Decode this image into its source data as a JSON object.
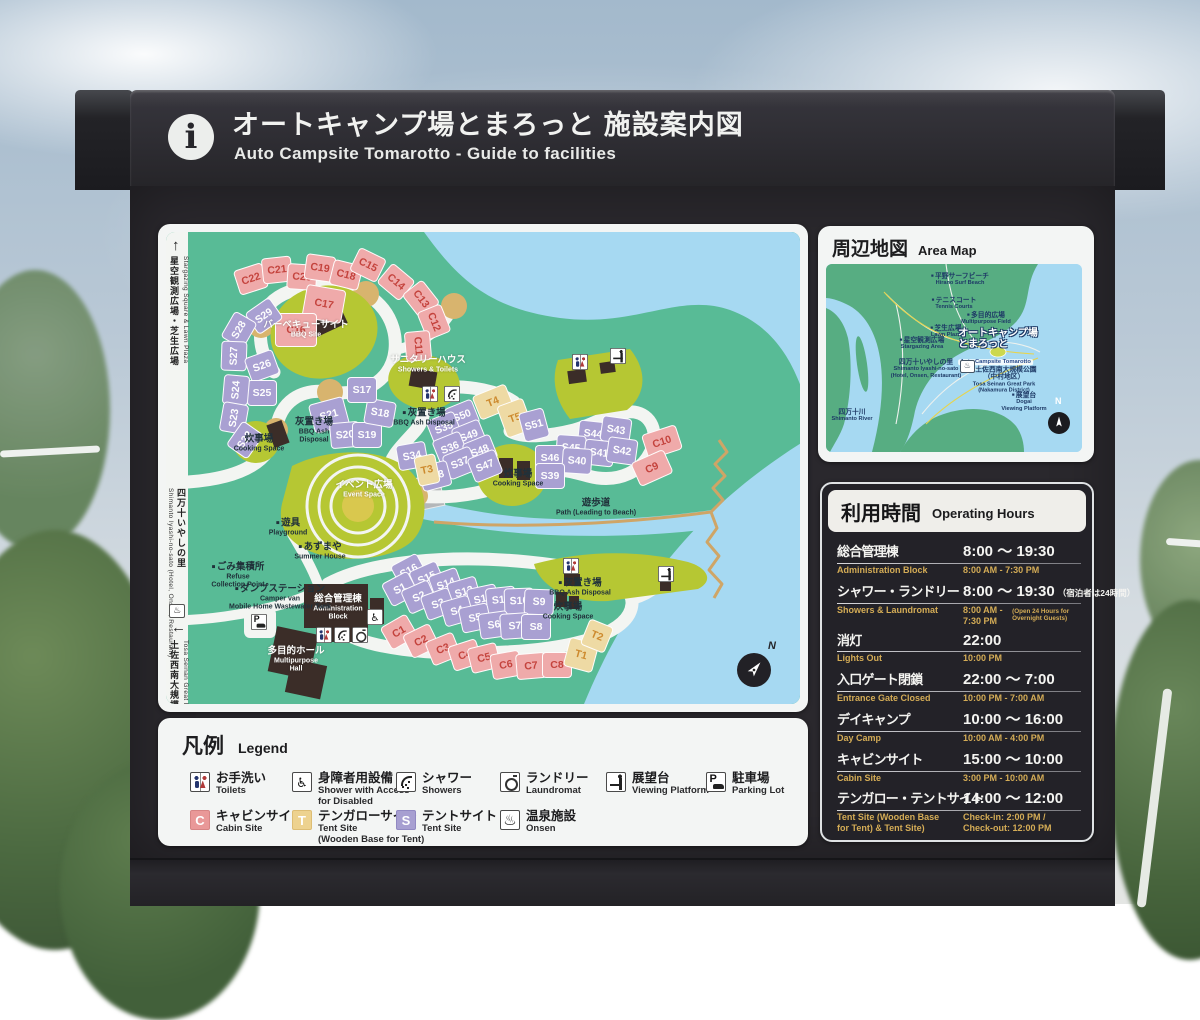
{
  "header": {
    "title_jp": "オートキャンプ場とまろっと 施設案内図",
    "title_en": "Auto Campsite Tomarotto - Guide to facilities",
    "info_icon": "i"
  },
  "main_map": {
    "compass_label": "N",
    "edge_routes": {
      "top": {
        "arrow": "↑",
        "jp": "星空観測広場・芝生広場",
        "en": "Stargazing Square & Lawn Plaza"
      },
      "middle": {
        "arrow": "←",
        "jp": "四万十いやしの里",
        "en": "Shimanto Iyashi-no-sato (Hotel, Onsen, Restaurant)",
        "onsen_icon": "♨"
      },
      "bottom": {
        "arrow": "↓",
        "jp": "土佐西南大規模公園",
        "en": "Tosa Seinan Great Park"
      }
    },
    "sites": [
      [
        "C22",
        "c",
        85,
        47,
        -18
      ],
      [
        "C21",
        "c",
        111,
        38,
        -6
      ],
      [
        "C20",
        "c",
        136,
        45,
        4
      ],
      [
        "C19",
        "c",
        154,
        36,
        8
      ],
      [
        "C18",
        "c",
        180,
        43,
        14
      ],
      [
        "C15",
        "c",
        202,
        33,
        26
      ],
      [
        "C14",
        "c",
        230,
        50,
        40
      ],
      [
        "C13",
        "c",
        255,
        67,
        52
      ],
      [
        "C12",
        "c",
        268,
        90,
        68
      ],
      [
        "C11",
        "c",
        252,
        114,
        85
      ],
      [
        "C17",
        "c",
        158,
        72,
        10,
        40,
        34
      ],
      [
        "C16",
        "c",
        130,
        98,
        0,
        42,
        34
      ],
      [
        "S29",
        "s",
        98,
        84,
        -35
      ],
      [
        "S28",
        "s",
        73,
        98,
        -60
      ],
      [
        "S27",
        "s",
        68,
        124,
        -88
      ],
      [
        "S26",
        "s",
        96,
        134,
        -20
      ],
      [
        "S25",
        "s",
        96,
        161,
        0
      ],
      [
        "S24",
        "s",
        70,
        158,
        -85
      ],
      [
        "S23",
        "s",
        68,
        186,
        -80
      ],
      [
        "S22",
        "s",
        79,
        208,
        -55
      ],
      [
        "S21",
        "s",
        163,
        183,
        -15,
        36,
        30
      ],
      [
        "S20",
        "s",
        179,
        203,
        -5
      ],
      [
        "S19",
        "s",
        201,
        203,
        0
      ],
      [
        "S18",
        "s",
        214,
        181,
        10
      ],
      [
        "S17",
        "s",
        196,
        158,
        0
      ],
      [
        "T4",
        "t",
        327,
        170,
        -22,
        36,
        26
      ],
      [
        "T5",
        "t",
        349,
        186,
        -20,
        28,
        34
      ],
      [
        "S50",
        "s",
        296,
        184,
        -22
      ],
      [
        "S35",
        "s",
        278,
        196,
        -22
      ],
      [
        "S49",
        "s",
        303,
        204,
        -22
      ],
      [
        "S36",
        "s",
        284,
        216,
        -22
      ],
      [
        "S48",
        "s",
        314,
        219,
        -22
      ],
      [
        "S34",
        "s",
        246,
        224,
        -10
      ],
      [
        "S37",
        "s",
        294,
        231,
        -22
      ],
      [
        "S47",
        "s",
        319,
        234,
        -22
      ],
      [
        "S38",
        "s",
        269,
        244,
        -15
      ],
      [
        "T3",
        "t",
        261,
        238,
        -12,
        22,
        30
      ],
      [
        "S51",
        "s",
        368,
        193,
        -15,
        26,
        30
      ],
      [
        "S44",
        "s",
        427,
        202,
        6
      ],
      [
        "S43",
        "s",
        450,
        198,
        8
      ],
      [
        "S45",
        "s",
        405,
        216,
        4
      ],
      [
        "S41",
        "s",
        433,
        221,
        6
      ],
      [
        "S42",
        "s",
        456,
        219,
        8
      ],
      [
        "S46",
        "s",
        384,
        226,
        0
      ],
      [
        "S40",
        "s",
        411,
        229,
        4
      ],
      [
        "S39",
        "s",
        384,
        244,
        0
      ],
      [
        "C10",
        "c",
        496,
        210,
        -18,
        36,
        26
      ],
      [
        "C9",
        "c",
        486,
        236,
        -24,
        36,
        26
      ],
      [
        "S16",
        "s",
        243,
        339,
        -28
      ],
      [
        "S15",
        "s",
        261,
        346,
        -24
      ],
      [
        "S14",
        "s",
        280,
        352,
        -20
      ],
      [
        "S13",
        "s",
        298,
        360,
        -16
      ],
      [
        "S12",
        "s",
        317,
        367,
        -12
      ],
      [
        "S11",
        "s",
        335,
        368,
        -6
      ],
      [
        "S10",
        "s",
        353,
        369,
        -2
      ],
      [
        "S9",
        "s",
        373,
        370,
        2
      ],
      [
        "S1",
        "s",
        234,
        357,
        -28
      ],
      [
        "S2",
        "s",
        253,
        365,
        -24
      ],
      [
        "S3",
        "s",
        272,
        372,
        -20
      ],
      [
        "S4",
        "s",
        291,
        379,
        -16
      ],
      [
        "S5",
        "s",
        309,
        386,
        -12
      ],
      [
        "S6",
        "s",
        328,
        393,
        -8
      ],
      [
        "S7",
        "s",
        349,
        394,
        -4
      ],
      [
        "S8",
        "s",
        370,
        395,
        0
      ],
      [
        "C1",
        "c",
        233,
        400,
        -30
      ],
      [
        "C2",
        "c",
        255,
        409,
        -26
      ],
      [
        "C3",
        "c",
        277,
        417,
        -22
      ],
      [
        "C4",
        "c",
        299,
        423,
        -18
      ],
      [
        "C5",
        "c",
        318,
        426,
        -14
      ],
      [
        "C6",
        "c",
        340,
        433,
        -10
      ],
      [
        "C7",
        "c",
        365,
        434,
        -5
      ],
      [
        "C8",
        "c",
        391,
        433,
        0
      ],
      [
        "T1",
        "t",
        415,
        423,
        15,
        30,
        30
      ],
      [
        "T2",
        "t",
        431,
        404,
        22,
        26,
        28
      ]
    ],
    "labels": [
      {
        "jp": "バーベキューサイト",
        "en": "BBQ Site",
        "x": 140,
        "y": 98,
        "s": "light"
      },
      {
        "jp": "サニタリーハウス",
        "en": "Showers & Toilets",
        "x": 262,
        "y": 133,
        "s": "light"
      },
      {
        "jp": "イベント広場",
        "en": "Event Space",
        "x": 198,
        "y": 258,
        "s": "light"
      },
      {
        "jp": "総合管理棟",
        "en": "Administration\nBlock",
        "x": 172,
        "y": 376,
        "s": "light"
      },
      {
        "jp": "多目的ホール",
        "en": "Multipurpose\nHall",
        "x": 130,
        "y": 428,
        "s": "light"
      },
      {
        "jp": "炊事場",
        "en": "Cooking Space",
        "x": 93,
        "y": 212,
        "s": "dark"
      },
      {
        "jp": "灰置き場",
        "en": "BBQ Ash\nDisposal",
        "x": 148,
        "y": 199,
        "s": "dark"
      },
      {
        "jp": "灰置き場",
        "en": "BBQ Ash Disposal",
        "x": 258,
        "y": 186,
        "s": "dark",
        "dot": true
      },
      {
        "jp": "炊事場",
        "en": "Cooking Space",
        "x": 352,
        "y": 247,
        "s": "dark"
      },
      {
        "jp": "灰置き場",
        "en": "BBQ Ash Disposal",
        "x": 414,
        "y": 356,
        "s": "dark",
        "dot": true
      },
      {
        "jp": "炊事場",
        "en": "Cooking Space",
        "x": 402,
        "y": 380,
        "s": "dark"
      },
      {
        "jp": "遊具",
        "en": "Playground",
        "x": 122,
        "y": 296,
        "s": "dark",
        "dot": true
      },
      {
        "jp": "あずまや",
        "en": "Summer House",
        "x": 154,
        "y": 320,
        "s": "dark",
        "dot": true
      },
      {
        "jp": "ごみ集積所",
        "en": "Refuse\nCollection Point",
        "x": 72,
        "y": 344,
        "s": "dark",
        "dot": true
      },
      {
        "jp": "ダンプステーション",
        "en": "Camper van\nMobile Home Wastewater Tank",
        "x": 114,
        "y": 366,
        "s": "dark",
        "dot": true
      },
      {
        "jp": "遊歩道",
        "en": "Path (Leading to Beach)",
        "x": 430,
        "y": 276,
        "s": "dark"
      }
    ],
    "icons": [
      {
        "k": "toilets",
        "x": 264,
        "y": 162
      },
      {
        "k": "shower",
        "x": 286,
        "y": 162
      },
      {
        "k": "toilets",
        "x": 414,
        "y": 130
      },
      {
        "k": "viewpoint",
        "x": 452,
        "y": 124
      },
      {
        "k": "toilets",
        "x": 405,
        "y": 334
      },
      {
        "k": "viewpoint",
        "x": 500,
        "y": 342
      },
      {
        "k": "toilets",
        "x": 158,
        "y": 403
      },
      {
        "k": "shower",
        "x": 176,
        "y": 403
      },
      {
        "k": "laundry",
        "x": 194,
        "y": 403
      },
      {
        "k": "accessible",
        "x": 209,
        "y": 385
      },
      {
        "k": "parking",
        "x": 93,
        "y": 390
      }
    ]
  },
  "area_map": {
    "title_jp": "周辺地図",
    "title_en": "Area Map",
    "compass_label": "N",
    "highlight": {
      "jp": "オートキャンプ場\nとまろっと",
      "en": "Auto Campsite Tomarotto",
      "x": 172,
      "y": 84
    },
    "onsen_icon": "♨",
    "labels": [
      {
        "jp": "平野サーフビーチ",
        "en": "Hirano Surf Beach",
        "x": 134,
        "y": 16,
        "dot": true
      },
      {
        "jp": "テニスコート",
        "en": "Tennis Courts",
        "x": 128,
        "y": 40,
        "dot": true
      },
      {
        "jp": "多目的広場",
        "en": "Multipurpose Field",
        "x": 160,
        "y": 55,
        "dot": true
      },
      {
        "jp": "芝生広場",
        "en": "Lawn Plaza",
        "x": 120,
        "y": 68,
        "dot": true
      },
      {
        "jp": "星空観測広場",
        "en": "Stargazing Area",
        "x": 96,
        "y": 80,
        "dot": true
      },
      {
        "jp": "四万十いやしの里",
        "en": "Shimanto Iyashi-no-sato\n(Hotel, Onsen, Restaurant)",
        "x": 100,
        "y": 105
      },
      {
        "jp": "土佐西南大規模公園（中村地区）",
        "en": "Tosa Seinan Great Park\n(Nakamura District)",
        "x": 178,
        "y": 116,
        "dot": true
      },
      {
        "jp": "展望台",
        "en": "Dogai\nViewing Platform",
        "x": 198,
        "y": 138,
        "dot": true
      },
      {
        "jp": "四万十川",
        "en": "Shimanto River",
        "x": 26,
        "y": 152
      }
    ]
  },
  "hours": {
    "title_jp": "利用時間",
    "title_en": "Operating Hours",
    "rows": [
      {
        "jp": "総合管理棟",
        "time": "8:00 ～ 19:30",
        "note": "",
        "en": "Administration Block",
        "en_time": "8:00 AM - 7:30 PM",
        "en_note": ""
      },
      {
        "jp": "シャワー・ランドリー",
        "time": "8:00 ～ 19:30",
        "note": "（宿泊者は24時間）",
        "en": "Showers & Laundromat",
        "en_time": "8:00 AM - 7:30 PM",
        "en_note": "(Open 24 Hours for Overnight Guests)"
      },
      {
        "jp": "消灯",
        "time": "22:00",
        "note": "",
        "en": "Lights Out",
        "en_time": "10:00 PM",
        "en_note": ""
      },
      {
        "jp": "入口ゲート閉鎖",
        "time": "22:00 ～ 7:00",
        "note": "",
        "en": "Entrance Gate Closed",
        "en_time": "10:00 PM - 7:00 AM",
        "en_note": ""
      },
      {
        "jp": "デイキャンプ",
        "time": "10:00 ～ 16:00",
        "note": "",
        "en": "Day Camp",
        "en_time": "10:00 AM - 4:00 PM",
        "en_note": ""
      },
      {
        "jp": "キャビンサイト",
        "time": "15:00 ～ 10:00",
        "note": "",
        "en": "Cabin Site",
        "en_time": "3:00 PM - 10:00 AM",
        "en_note": ""
      },
      {
        "jp": "テンガロー・テントサイト",
        "time": "14:00 ～ 12:00",
        "note": "",
        "en": "Tent Site (Wooden Base\nfor Tent) & Tent Site)",
        "en_time": "Check-in: 2:00 PM /\nCheck-out: 12:00 PM",
        "en_note": ""
      }
    ]
  },
  "legend": {
    "title_jp": "凡例",
    "title_en": "Legend",
    "items": [
      {
        "k": "toilets",
        "jp": "お手洗い",
        "en": "Toilets",
        "x": 8,
        "y": 36
      },
      {
        "k": "accessible",
        "jp": "身障者用設備",
        "en": "Shower with Access\nfor Disabled",
        "x": 110,
        "y": 36
      },
      {
        "k": "shower",
        "jp": "シャワー",
        "en": "Showers",
        "x": 214,
        "y": 36
      },
      {
        "k": "laundry",
        "jp": "ランドリー",
        "en": "Laundromat",
        "x": 318,
        "y": 36
      },
      {
        "k": "viewpoint",
        "jp": "展望台",
        "en": "Viewing Platform",
        "x": 424,
        "y": 36
      },
      {
        "k": "parking",
        "jp": "駐車場",
        "en": "Parking Lot",
        "x": 524,
        "y": 36
      },
      {
        "k": "c",
        "letter": "C",
        "jp": "キャビンサイト",
        "en": "Cabin Site",
        "x": 8,
        "y": 74
      },
      {
        "k": "t",
        "letter": "T",
        "jp": "テンガローサイト",
        "en": "Tent Site\n(Wooden Base for Tent)",
        "x": 110,
        "y": 74
      },
      {
        "k": "s",
        "letter": "S",
        "jp": "テントサイト",
        "en": "Tent Site",
        "x": 214,
        "y": 74
      },
      {
        "k": "onsen",
        "jp": "温泉施設",
        "en": "Onsen",
        "x": 318,
        "y": 74
      }
    ]
  },
  "colors": {
    "site_cabin": "#efaaaa",
    "site_tent": "#a9a0d2",
    "site_tengalow": "#eedaa4",
    "land": "#58bb96",
    "water": "#a6d9f2",
    "facility_green": "#b6c733",
    "hours_accent": "#d4ac56",
    "building": "#3b2d28"
  }
}
